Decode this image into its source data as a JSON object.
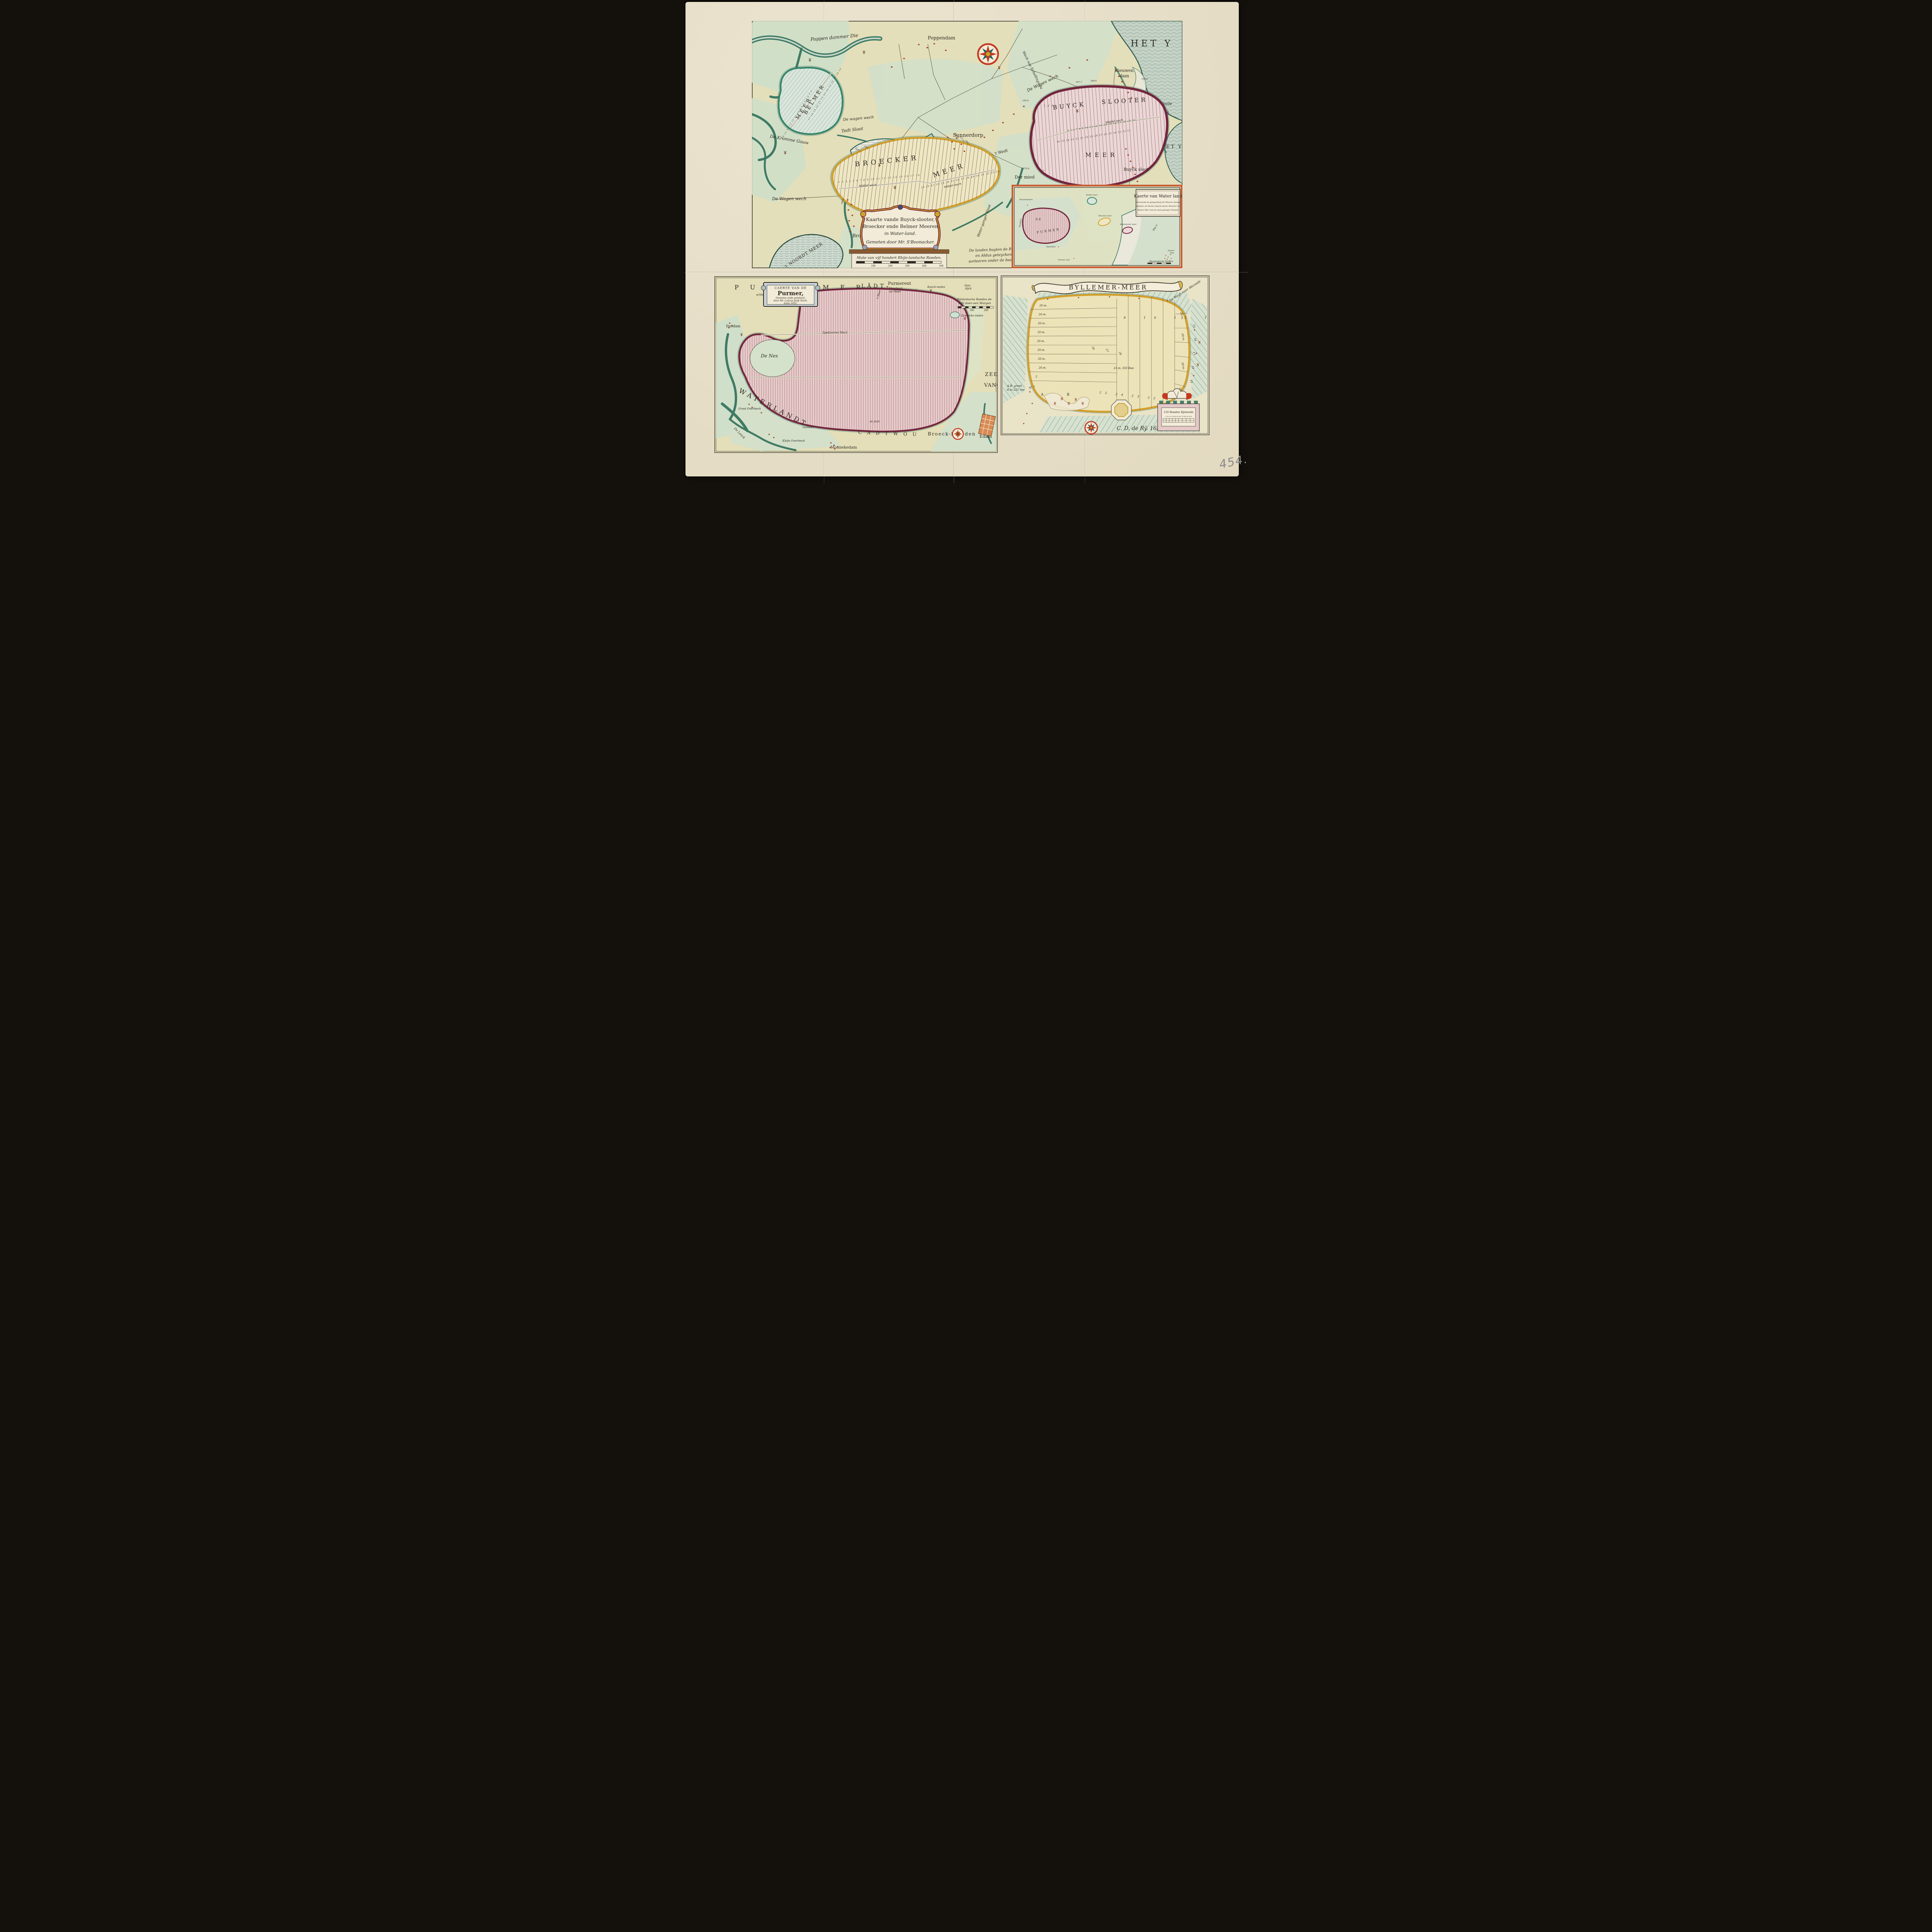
{
  "sheet": {
    "handwritten_number": "454."
  },
  "main_map": {
    "cartouche": {
      "line1": "Kaarte vande Buyck-slooter,",
      "line2": "Broecker ende Belmer Meeren",
      "line3": "in Water-land.",
      "line4": "Gemeten door Mr. S'Boonacker."
    },
    "scale_label": "Mate van vÿf hondert Rhÿn-landsche Roeden.",
    "scale_ticks": [
      "100",
      "200",
      "300",
      "400",
      "500"
    ],
    "note_line1": "De landen buyten de Ring-slooten gelegen",
    "note_line2": "en Aldus geteyckent o.",
    "note_line3": "sorteeren onder de bedyckinge als eygen",
    "sea_label_large": "HET Y",
    "sea_label_small": "HET Y",
    "labels": {
      "voole_wyck_1": "De Voole",
      "voole_wyck_2": "wyck",
      "nieuwendam_1": "Nieuwen",
      "nieuwendam_2": "dam",
      "poppendammer_die": "Poppen dammer Die",
      "poppendam": "Poppendam",
      "schellingwou": "Wech nae Schellingwou",
      "wagen_wech_right": "De Wagen wech",
      "sunnerdorp": "Sunnerdorp",
      "t_wedt": "'t Wedt",
      "tedt_sloot": "Tedt Sloot",
      "burch_moer": "BURCH-MOER-MEER",
      "wagen_wech_mid": "De wagen wech",
      "kromme_gouw": "De Kromme Gouw",
      "wagen_wech_left": "De Wagen wech",
      "broek": "Broek",
      "der_mied": "Der mied",
      "slochter": "Slochter",
      "dyck_sloot": "Dyck Sloot",
      "waterganger_sloot": "Water-ganger Sloot",
      "noordt_meer": "'t NOORDT MEER",
      "buyck_sloot_village": "Buyck sloot"
    },
    "belmer": {
      "name1": "BELMER",
      "name2": "MEER",
      "rest": "rest",
      "numbers_a": "16 15 14 13 12 11 10 9 8 7 6 5 4 3 2",
      "numbers_b": "17 18 19 20 21 22 23 24 25 26 27 28 29"
    },
    "broecker": {
      "name1": "BROECKER",
      "name2": "MEER",
      "middel_wech_top": "Middel wech",
      "middel_wech_low": "Middel wech",
      "numbers_a": "1 2 3 4 5 6 7 8 9 10 11 12 13 14 15 16 17 18",
      "numbers_b": "19 20 21 22 23 24 25 26 27 28 29 30 31 32 33 34"
    },
    "buyck": {
      "name1": "BUYCK",
      "name2": "SLOOTER",
      "name3": "MEER",
      "middel_wech": "Middel wech",
      "numbers_a": "1 2 3",
      "numbers_b": "4 5 6 7 8 9 10 11 12 13 14 15 16 17 18 19 20",
      "numbers_c": "36 35 34 33 32 31 30 29 28 27 26 25 24 23 22 21",
      "n37": "37"
    },
    "numbers": {
      "n1677": "167.7.",
      "n1890": "189.0.",
      "n1540": "154.0.",
      "n1050": "105.0.",
      "n2750": "275.0.",
      "n2057": "205.0.",
      "n1560": "156.0.",
      "n1180": "118.0.",
      "n2577": "257.7.",
      "n526": "52.6.",
      "n2000": "200.0.",
      "n2370": "237.0.",
      "n2407": "240.7.",
      "n1520": "152.0."
    }
  },
  "inset": {
    "title": "Kaerte van Water land",
    "sub1": "Vertonende de gelegentheyt der Meeren onlangs",
    "sub2": "bedyckt, als Purmer, Buyck-slooter, Broecker en",
    "sub3": "Belmer Meer met de naest ghelegen Steeden",
    "labels": {
      "de": "DE",
      "purmer": "PURMER",
      "monnekedam": "Monnekedam",
      "ilpendam": "Ilpendam",
      "purmer_end": "Purmer end",
      "quadyck": "Quadyck",
      "belmer": "Belmer meer",
      "broecker": "Broecker meer",
      "buyck": "Buyckslooter meer",
      "het_y": "Het Y",
      "amsterdam_1": "Amster",
      "amsterdam_2": "dam",
      "scale": "Rhynlandsche Roeden"
    }
  },
  "purmer": {
    "margin": {
      "pur": "P U R",
      "mer": "M E R",
      "ladt": "LÃDT",
      "de": "De",
      "achter": "achter Dichting"
    },
    "cartouche": {
      "line1": "CAERTE VAN DE",
      "line2": "Purmer,",
      "line3": "Gemeten ende getekent,",
      "line4": "door Mr. Luÿcas Janß Sinck.",
      "line5": "Anno 1622."
    },
    "labels": {
      "purmerent": "Purmerent",
      "visschery1": "Visscherÿ",
      "visschery2": "ter Weer",
      "t_weer": "'t Weer",
      "kooch": "Kooch-molen",
      "quadyck1": "Qua:",
      "quadyck2": "dÿck",
      "roeden1": "Rÿnlantsche Roeden de",
      "roeden2": "600 doen een Morgen",
      "tick100": "100",
      "tick200": "200",
      "zevancks": "Zevancks molen",
      "ilpedam": "Ilpedam",
      "ilpedammer_wech": "Ilpedammer Wech",
      "de_nes": "De Nes",
      "waterlandt": "WATERLANDT",
      "groot_overleeck": "Groot Overleeck",
      "de_leeck": "De Leeck",
      "kleyn_overleeck": "Kleÿn Overleeck",
      "galileen": "Galileen",
      "monnekedam": "Monnekedam",
      "cadtwou": "C A D T W O U",
      "de_zedt": "de Zedt",
      "broeck_lan": "Broeck-lan",
      "den": "den",
      "edam": "Edam",
      "zee": "ZEE",
      "vanc": "VANC"
    }
  },
  "byllemer": {
    "banner": "BYLLEMER-MEER",
    "labels": {
      "abcoude": "De Wegh naer Abcoude",
      "signature": "C. D. de Rÿ. 1626",
      "ab_groot1": "A.B. groot",
      "ab_groot2": "8.m 231 roe",
      "m350": "21.m. 350 Roe:",
      "twenty": "20.m.",
      "no1": "N° 1",
      "two": "2",
      "a": "A",
      "b": "B",
      "col_numbers": "9 10 11 12 13 14",
      "row_25_22": "25 24 23 22",
      "n28": "28",
      "n27": "27",
      "n26": "26",
      "n15": "15",
      "n16": "16",
      "n17": "17",
      "n18": "18",
      "n19": "19",
      "n20": "20",
      "scale_title": "150 Roeden Rÿnlands",
      "scale_ticks": "5 10 20 30 40 50 60 70 80 90 100"
    }
  }
}
